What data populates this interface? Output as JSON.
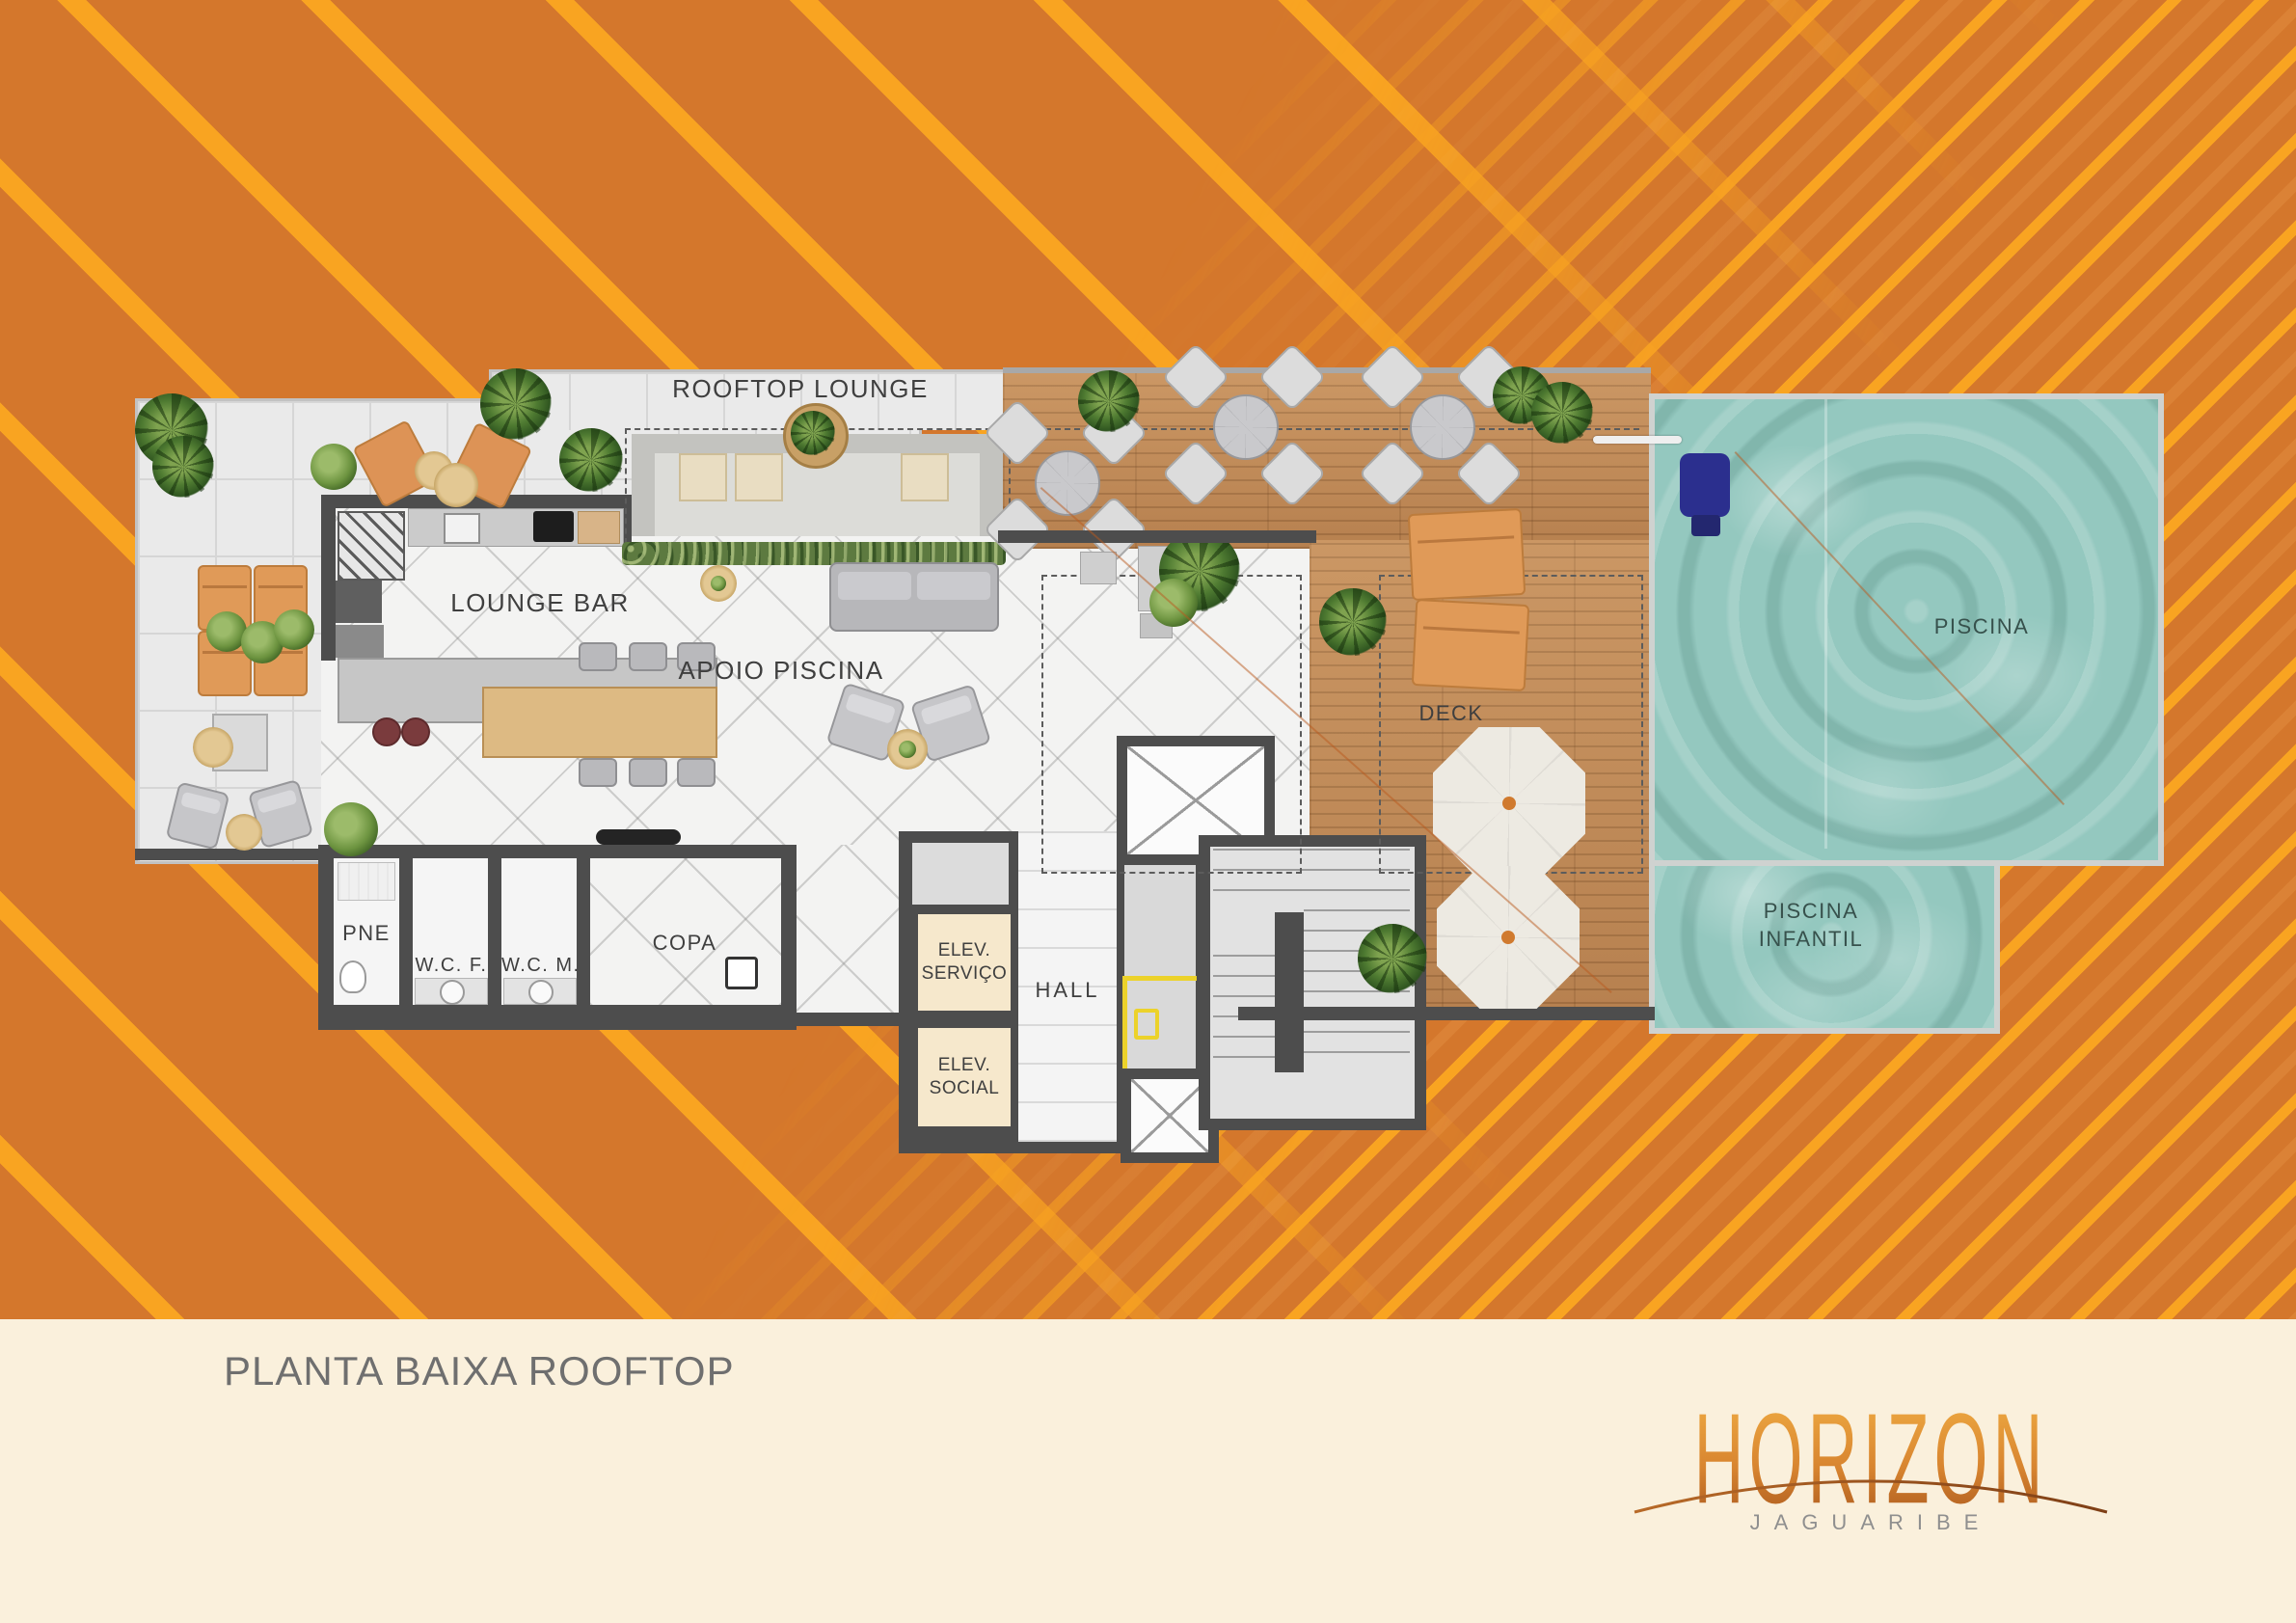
{
  "colors": {
    "background_orange": "#d4772c",
    "stripe_orange": "#f9a421",
    "footer_cream": "#faf0dc",
    "wall_dark": "#4d4d4d",
    "wood_deck": "#c18a57",
    "pool_water": "#94c8bf",
    "marking_yellow": "#ecd22a",
    "logo_gradient_top": "#f2b045",
    "logo_gradient_bottom": "#a2511b"
  },
  "plan": {
    "labels": {
      "rooftop_lounge": "ROOFTOP LOUNGE",
      "lounge_bar": "LOUNGE BAR",
      "apoio_piscina": "APOIO PISCINA",
      "deck": "DECK",
      "piscina": "PISCINA",
      "piscina_infantil_1": "PISCINA",
      "piscina_infantil_2": "INFANTIL",
      "pne": "PNE",
      "wc_f": "W.C. F.",
      "wc_m": "W.C. M.",
      "copa": "COPA",
      "elev_servico_1": "ELEV.",
      "elev_servico_2": "SERVIÇO",
      "hall": "HALL",
      "elev_social_1": "ELEV.",
      "elev_social_2": "SOCIAL"
    }
  },
  "footer": {
    "caption": "PLANTA BAIXA ROOFTOP",
    "logo_name": "HORIZON",
    "logo_subtitle": "JAGUARIBE"
  }
}
